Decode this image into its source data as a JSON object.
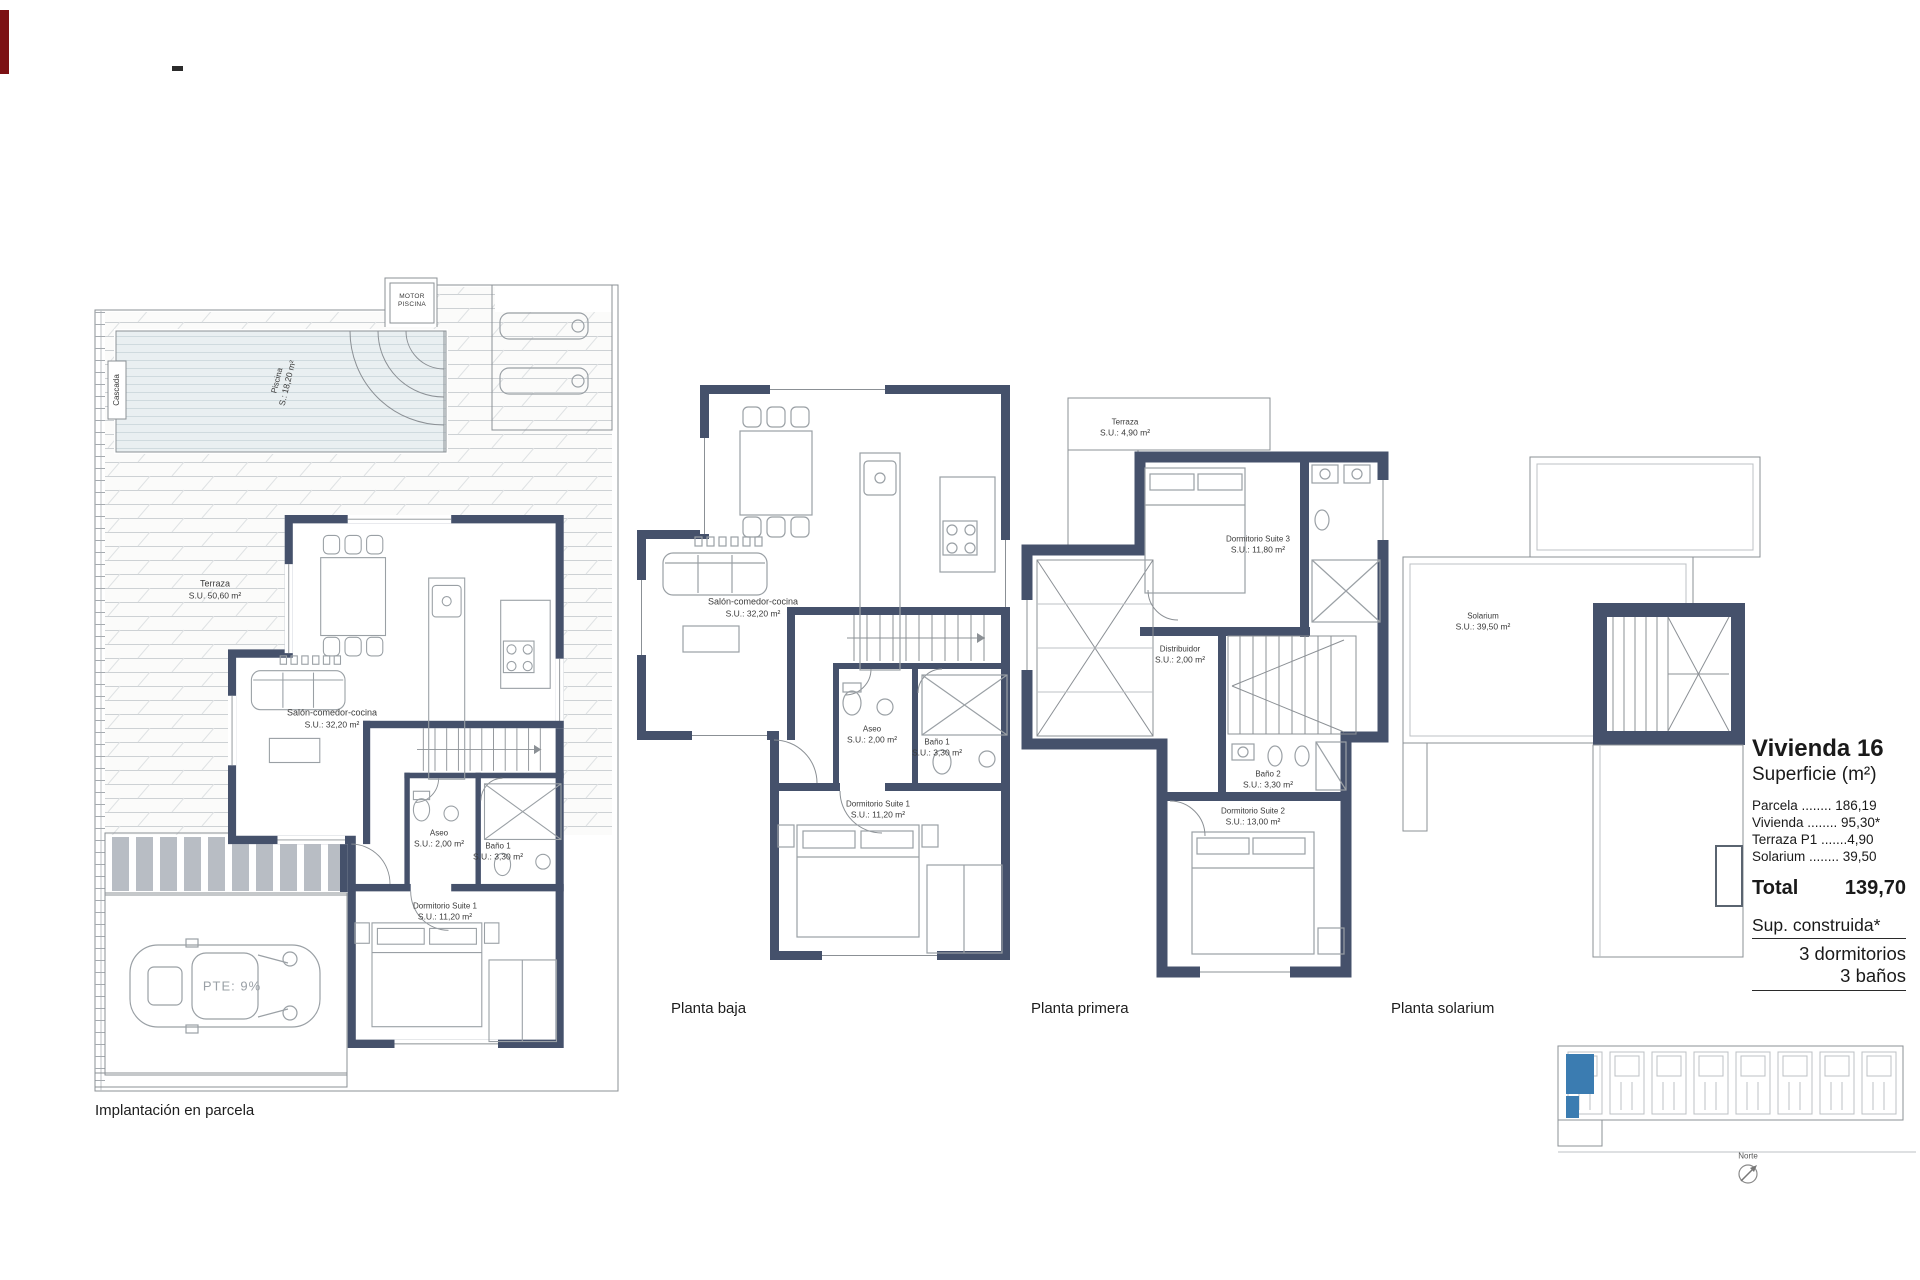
{
  "colors": {
    "wall": "#45516b",
    "accent_blue": "#3b7cb1",
    "pool_fill": "#e9eff1",
    "artifact_red": "#7c1114"
  },
  "plans": {
    "implantacion": {
      "caption": "Implantación en parcela",
      "rooms": {
        "cascada": {
          "name": "Cascada"
        },
        "piscina": {
          "name": "Piscina",
          "area": "S.: 18,20 m²"
        },
        "motor": {
          "line1": "MOTOR",
          "line2": "PISCINA"
        },
        "terraza": {
          "name": "Terraza",
          "area": "S.U. 50,60 m²"
        },
        "salon": {
          "name": "Salón-comedor-cocina",
          "area": "S.U.: 32,20 m²"
        },
        "aseo": {
          "name": "Aseo",
          "area": "S.U.: 2,00 m²"
        },
        "bano1": {
          "name": "Baño 1",
          "area": "S.U.: 3,30 m²"
        },
        "dormitorio1": {
          "name": "Dormitorio Suite 1",
          "area": "S.U.: 11,20 m²"
        },
        "rampa": {
          "name": "PTE: 9%"
        }
      }
    },
    "planta_baja": {
      "caption": "Planta baja",
      "rooms": {
        "salon": {
          "name": "Salón-comedor-cocina",
          "area": "S.U.: 32,20 m²"
        },
        "aseo": {
          "name": "Aseo",
          "area": "S.U.: 2,00 m²"
        },
        "bano1": {
          "name": "Baño 1",
          "area": "S.U.: 3,30 m²"
        },
        "dormitorio1": {
          "name": "Dormitorio Suite 1",
          "area": "S.U.: 11,20 m²"
        }
      }
    },
    "planta_primera": {
      "caption": "Planta primera",
      "rooms": {
        "terraza": {
          "name": "Terraza",
          "area": "S.U.: 4,90 m²"
        },
        "dormitorio3": {
          "name": "Dormitorio Suite 3",
          "area": "S.U.: 11,80 m²"
        },
        "distribuidor": {
          "name": "Distribuidor",
          "area": "S.U.: 2,00 m²"
        },
        "bano2": {
          "name": "Baño 2",
          "area": "S.U.: 3,30 m²"
        },
        "dormitorio2": {
          "name": "Dormitorio Suite 2",
          "area": "S.U.: 13,00 m²"
        }
      }
    },
    "planta_solarium": {
      "caption": "Planta solarium",
      "rooms": {
        "solarium": {
          "name": "Solarium",
          "area": "S.U.: 39,50 m²"
        }
      }
    }
  },
  "info_panel": {
    "title": "Vivienda 16",
    "subtitle": "Superficie (m²)",
    "rows": [
      "Parcela ........ 186,19",
      "Vivienda ........ 95,30*",
      "Terraza P1 .......4,90",
      "Solarium ........ 39,50"
    ],
    "total_label": "Total",
    "total_value": "139,70",
    "built_label": "Sup. construida*",
    "bedrooms": "3 dormitorios",
    "bathrooms": "3 baños"
  },
  "site_plan": {
    "north_label": "Norte",
    "units_total": 8,
    "highlighted_unit": "Vivienda 16"
  }
}
